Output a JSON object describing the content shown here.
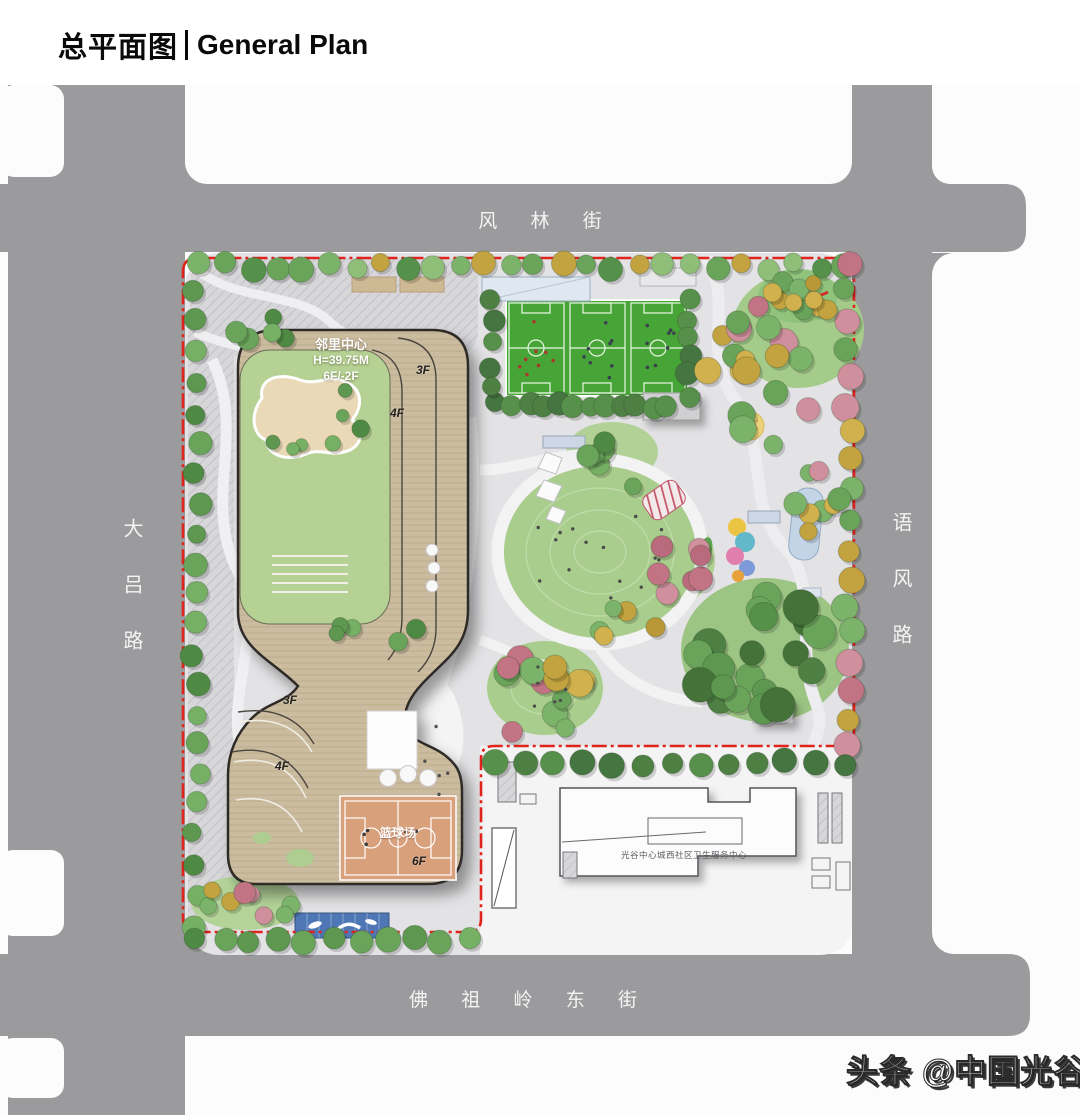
{
  "title": {
    "zh": "总平面图",
    "en": "General Plan"
  },
  "roads": {
    "north": "风 林 街",
    "west": "大吕路",
    "east": "语风路",
    "south": "佛 祖 岭 东 街"
  },
  "building": {
    "name": "邻里中心",
    "height": "H=39.75M",
    "floors": "6F/-2F",
    "tags": {
      "upper_3f": "3F",
      "upper_4f": "4F",
      "lower_3f": "3F",
      "lower_4f": "4F",
      "roof_6f": "6F"
    },
    "basketball_court": "篮球场"
  },
  "health_center": {
    "name": "光谷中心城西社区卫生服务中心"
  },
  "watermark": {
    "text": "头条 @中国光谷"
  },
  "colors": {
    "road_gray": "#9b9b9d",
    "site_gray": "#e3e3e5",
    "parking_gray": "#d7d7da",
    "health_parcel": "#f4f4f5",
    "boundary_red": "#e0231b",
    "field_green": "#47a436",
    "lawn_green": "#a9cd8c",
    "building_tan": "#cbbc9f",
    "roof_green": "#b5d193",
    "pond_cream": "#ead9b6",
    "court_orange": "#d9a07b",
    "canopy_blue": "#4f77b5"
  },
  "decor": {
    "palettes": {
      "mixed": [
        "#6aa45b",
        "#7cb36a",
        "#55914a",
        "#c3a33f",
        "#8fbe79",
        "#6aa45b"
      ],
      "green": [
        "#6aa45b",
        "#5d9750",
        "#76b065",
        "#4f8a44"
      ],
      "dark": [
        "#4e8044",
        "#457540",
        "#57904b"
      ],
      "fall": [
        "#c3a33f",
        "#d0b14e",
        "#b99838",
        "#7cb36a"
      ],
      "pink": [
        "#c27485",
        "#cf8f9d",
        "#b96a7c"
      ],
      "se": [
        "#4e8044",
        "#5d9750",
        "#6aa45b",
        "#447239",
        "#559149"
      ],
      "mixed2": [
        "#c3a33f",
        "#c27485",
        "#6aa45b",
        "#d0b14e",
        "#cf8f9d",
        "#7cb36a"
      ]
    },
    "rows": [
      {
        "x1": 200,
        "y1": 266,
        "x2": 845,
        "y2": 266,
        "n": 26,
        "rmin": 9,
        "rmax": 13,
        "jx": 3,
        "jy": 4,
        "palette": "mixed"
      },
      {
        "x1": 196,
        "y1": 292,
        "x2": 196,
        "y2": 925,
        "n": 22,
        "rmin": 9,
        "rmax": 12,
        "jx": 5,
        "jy": 3,
        "palette": "green"
      },
      {
        "x1": 848,
        "y1": 262,
        "x2": 848,
        "y2": 748,
        "n": 18,
        "rmin": 10,
        "rmax": 14,
        "jx": 6,
        "jy": 4,
        "palette": "mixed2"
      },
      {
        "x1": 196,
        "y1": 940,
        "x2": 468,
        "y2": 940,
        "n": 11,
        "rmin": 10,
        "rmax": 13,
        "jx": 3,
        "jy": 3,
        "palette": "green"
      },
      {
        "x1": 497,
        "y1": 763,
        "x2": 845,
        "y2": 763,
        "n": 13,
        "rmin": 10,
        "rmax": 13,
        "jx": 3,
        "jy": 3,
        "palette": "dark"
      },
      {
        "x1": 497,
        "y1": 402,
        "x2": 668,
        "y2": 409,
        "n": 12,
        "rmin": 9,
        "rmax": 12,
        "jx": 3,
        "jy": 3,
        "palette": "dark"
      },
      {
        "x1": 688,
        "y1": 300,
        "x2": 690,
        "y2": 395,
        "n": 6,
        "rmin": 9,
        "rmax": 12,
        "jx": 3,
        "jy": 3,
        "palette": "dark"
      },
      {
        "x1": 492,
        "y1": 300,
        "x2": 492,
        "y2": 388,
        "n": 5,
        "rmin": 9,
        "rmax": 11,
        "jx": 3,
        "jy": 3,
        "palette": "dark"
      }
    ],
    "clusters": [
      {
        "cx": 772,
        "cy": 360,
        "rx": 70,
        "ry": 92,
        "n": 24,
        "rmin": 8,
        "rmax": 14,
        "palette": "mixed2"
      },
      {
        "cx": 678,
        "cy": 568,
        "rx": 28,
        "ry": 30,
        "n": 7,
        "rmin": 9,
        "rmax": 13,
        "palette": "pink"
      },
      {
        "cx": 765,
        "cy": 655,
        "rx": 78,
        "ry": 68,
        "n": 20,
        "rmin": 11,
        "rmax": 18,
        "palette": "se"
      },
      {
        "cx": 540,
        "cy": 690,
        "rx": 55,
        "ry": 50,
        "n": 13,
        "rmin": 9,
        "rmax": 14,
        "palette": "mixed2"
      },
      {
        "cx": 600,
        "cy": 468,
        "rx": 48,
        "ry": 28,
        "n": 6,
        "rmin": 8,
        "rmax": 12,
        "palette": "green"
      },
      {
        "cx": 310,
        "cy": 420,
        "rx": 52,
        "ry": 42,
        "n": 7,
        "rmin": 6,
        "rmax": 9,
        "palette": "green"
      },
      {
        "cx": 252,
        "cy": 332,
        "rx": 42,
        "ry": 22,
        "n": 5,
        "rmin": 8,
        "rmax": 11,
        "palette": "green"
      },
      {
        "cx": 245,
        "cy": 905,
        "rx": 46,
        "ry": 22,
        "n": 8,
        "rmin": 8,
        "rmax": 12,
        "palette": "mixed2"
      },
      {
        "cx": 372,
        "cy": 632,
        "rx": 46,
        "ry": 23,
        "n": 5,
        "rmin": 7,
        "rmax": 10,
        "palette": "green"
      },
      {
        "cx": 820,
        "cy": 480,
        "rx": 28,
        "ry": 58,
        "n": 8,
        "rmin": 8,
        "rmax": 12,
        "palette": "mixed2"
      },
      {
        "cx": 620,
        "cy": 622,
        "rx": 38,
        "ry": 22,
        "n": 5,
        "rmin": 8,
        "rmax": 11,
        "palette": "fall"
      },
      {
        "cx": 800,
        "cy": 292,
        "rx": 30,
        "ry": 18,
        "n": 4,
        "rmin": 7,
        "rmax": 10,
        "palette": "fall"
      }
    ],
    "dots": [
      {
        "cx": 600,
        "cy": 552,
        "rx": 72,
        "ry": 60,
        "n": 15,
        "r": 1.7,
        "color": "#4a4a4a"
      },
      {
        "cx": 536,
        "cy": 348,
        "rx": 20,
        "ry": 38,
        "n": 8,
        "r": 1.8,
        "color": "#a93a2e"
      },
      {
        "cx": 597,
        "cy": 348,
        "rx": 20,
        "ry": 38,
        "n": 8,
        "r": 1.8,
        "color": "#39414e"
      },
      {
        "cx": 658,
        "cy": 348,
        "rx": 20,
        "ry": 38,
        "n": 8,
        "r": 1.8,
        "color": "#39414e"
      },
      {
        "cx": 436,
        "cy": 762,
        "rx": 16,
        "ry": 36,
        "n": 5,
        "r": 1.7,
        "color": "#4f4f4f"
      },
      {
        "cx": 399,
        "cy": 840,
        "rx": 38,
        "ry": 26,
        "n": 5,
        "r": 1.8,
        "color": "#3c3c3c"
      },
      {
        "cx": 545,
        "cy": 690,
        "rx": 34,
        "ry": 26,
        "n": 6,
        "r": 1.6,
        "color": "#4a4a4a"
      }
    ]
  }
}
